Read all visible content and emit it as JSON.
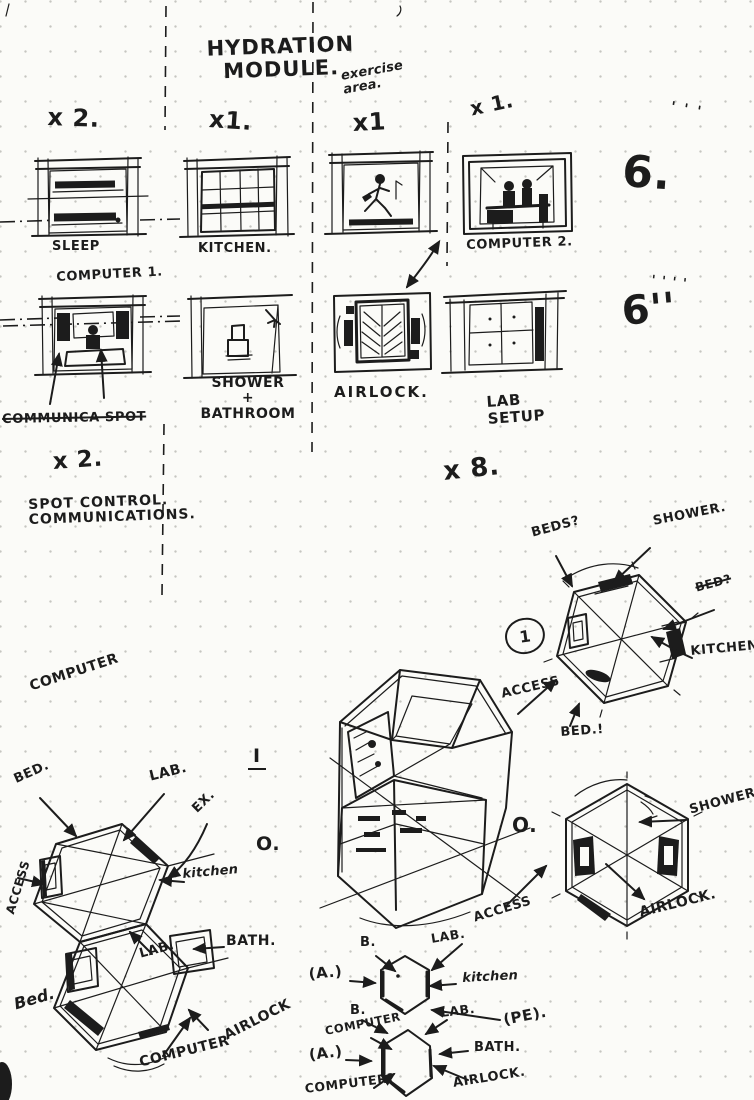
{
  "title": "HYDRATION\nMODULE.",
  "margin": {
    "ticks_top": "' ' '",
    "six_top": "6.",
    "ticks_bottom": "' ' ' '",
    "six_bottom": "6''"
  },
  "modules": {
    "sleep": {
      "count": "x 2.",
      "label": "SLEEP"
    },
    "kitchen": {
      "count": "x1.",
      "label": "KITCHEN."
    },
    "exercise": {
      "count": "x1",
      "note": "exercise\narea."
    },
    "computer2": {
      "count": "x 1.",
      "label": "COMPUTER 2."
    },
    "computer1": {
      "label": "COMPUTER 1."
    },
    "shower": {
      "label": "SHOWER\n+\nBATHROOM"
    },
    "airlock": {
      "label": "AIRLOCK."
    },
    "lab": {
      "label": "LAB\nSETUP",
      "count": "x 8."
    }
  },
  "notes": {
    "crossed": "COMMUNICA SPOT",
    "count": "x 2.",
    "control": "SPOT CONTROL.\nCOMMUNICATIONS."
  },
  "hexTopRight": {
    "badge": "1",
    "beds": "BEDS?",
    "shower": "SHOWER.",
    "bed_crossed": "BED?",
    "kitchen": "KITCHEN",
    "access": "ACCESS",
    "bed": "BED.!"
  },
  "hexLeft": {
    "computer": "COMPUTER",
    "bed": "BED.",
    "lab": "LAB.",
    "ex": "EX.",
    "marker_i": "I",
    "marker_o": "O.",
    "kitchen": "kitchen",
    "access": "ACCESS",
    "bath": "BATH.",
    "lab_inner": "LAB.",
    "bed_lower": "Bed.",
    "computer_lower": "COMPUTER",
    "airlock": "AIRLOCK"
  },
  "hexCenter": {
    "marker_o": "O."
  },
  "hexRight": {
    "shower": "SHOWER",
    "airlock": "AIRLOCK."
  },
  "hexA": {
    "b_top": "B.",
    "lab_access_1": "LAB.",
    "lab_access_2": "ACCESS",
    "a": "(A.)",
    "kitchen": "kitchen",
    "b_bottom": "B.",
    "lab": "LAB.",
    "pe": "(PE)."
  },
  "hexB": {
    "computer": "COMPUTER",
    "a": "(A.)",
    "bath": "BATH.",
    "computer_q": "COMPUTER?",
    "airlock": "AIRLOCK."
  }
}
